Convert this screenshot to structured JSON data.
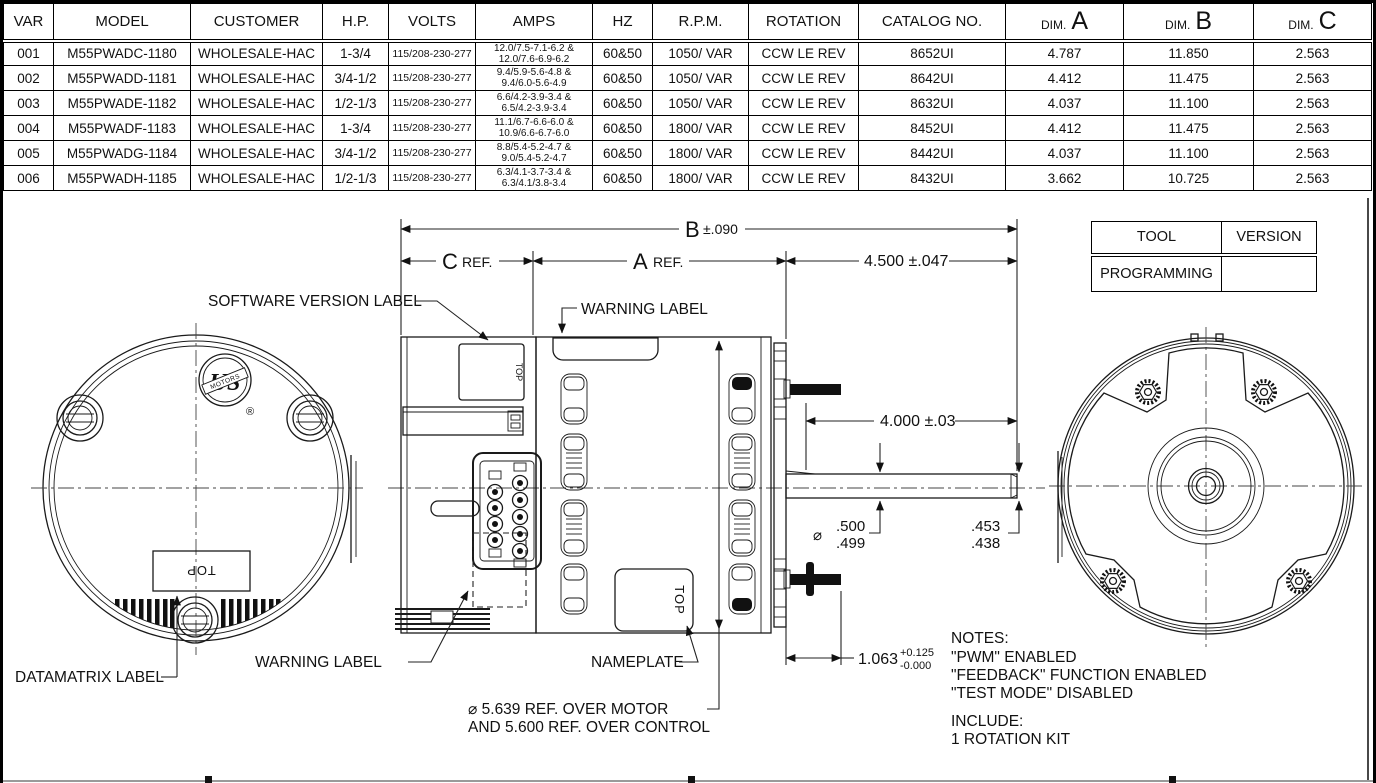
{
  "spec_table": {
    "columns": [
      {
        "label": "VAR"
      },
      {
        "label": "MODEL"
      },
      {
        "label": "CUSTOMER"
      },
      {
        "label": "H.P."
      },
      {
        "label": "VOLTS"
      },
      {
        "label": "AMPS"
      },
      {
        "label": "HZ"
      },
      {
        "label": "R.P.M."
      },
      {
        "label": "ROTATION"
      },
      {
        "label": "CATALOG NO."
      },
      {
        "label": "DIM.",
        "big": "A"
      },
      {
        "label": "DIM.",
        "big": "B"
      },
      {
        "label": "DIM.",
        "big": "C"
      }
    ],
    "rows": [
      [
        "001",
        "M55PWADC-1180",
        "WHOLESALE-HAC",
        "1-3/4",
        "115/208-230-277",
        "12.0/7.5-7.1-6.2 &\n12.0/7.6-6.9-6.2",
        "60&50",
        "1050/ VAR",
        "CCW LE REV",
        "8652UI",
        "4.787",
        "11.850",
        "2.563"
      ],
      [
        "002",
        "M55PWADD-1181",
        "WHOLESALE-HAC",
        "3/4-1/2",
        "115/208-230-277",
        "9.4/5.9-5.6-4.8 &\n9.4/6.0-5.6-4.9",
        "60&50",
        "1050/ VAR",
        "CCW LE REV",
        "8642UI",
        "4.412",
        "11.475",
        "2.563"
      ],
      [
        "003",
        "M55PWADE-1182",
        "WHOLESALE-HAC",
        "1/2-1/3",
        "115/208-230-277",
        "6.6/4.2-3.9-3.4 &\n6.5/4.2-3.9-3.4",
        "60&50",
        "1050/ VAR",
        "CCW LE REV",
        "8632UI",
        "4.037",
        "11.100",
        "2.563"
      ],
      [
        "004",
        "M55PWADF-1183",
        "WHOLESALE-HAC",
        "1-3/4",
        "115/208-230-277",
        "11.1/6.7-6.6-6.0 &\n10.9/6.6-6.7-6.0",
        "60&50",
        "1800/ VAR",
        "CCW LE REV",
        "8452UI",
        "4.412",
        "11.475",
        "2.563"
      ],
      [
        "005",
        "M55PWADG-1184",
        "WHOLESALE-HAC",
        "3/4-1/2",
        "115/208-230-277",
        "8.8/5.4-5.2-4.7 &\n9.0/5.4-5.2-4.7",
        "60&50",
        "1800/ VAR",
        "CCW LE REV",
        "8442UI",
        "4.037",
        "11.100",
        "2.563"
      ],
      [
        "006",
        "M55PWADH-1185",
        "WHOLESALE-HAC",
        "1/2-1/3",
        "115/208-230-277",
        "6.3/4.1-3.7-3.4 &\n6.3/4.1/3.8-3.4",
        "60&50",
        "1800/ VAR",
        "CCW LE REV",
        "8432UI",
        "3.662",
        "10.725",
        "2.563"
      ]
    ]
  },
  "tool_table": {
    "col1": "TOOL",
    "col2": "VERSION",
    "row1": {
      "tool": "PROGRAMMING",
      "version": ""
    }
  },
  "drawing": {
    "labels": {
      "software_version_label": "SOFTWARE VERSION LABEL",
      "warning_label_top": "WARNING LABEL",
      "warning_label_bottom": "WARNING LABEL",
      "datamatrix_label": "DATAMATRIX LABEL",
      "nameplate_label": "NAMEPLATE",
      "top_marking_back": "TOP",
      "top_marking_control": "TOP",
      "top_marking_nameplate": "TOP"
    },
    "dims": {
      "b_letter": "B",
      "b_tol": "±.090",
      "c_letter": "C",
      "c_suffix": "REF.",
      "a_letter": "A",
      "a_suffix": "REF.",
      "shaft_ext": "4.500 ±.047",
      "shaft_len": "4.000 ±.03",
      "dia_sym": "⌀",
      "shaft_dia_hi": ".500",
      "shaft_dia_lo": ".499",
      "flat_hi": ".453",
      "flat_lo": ".438",
      "stud_len": "1.063",
      "stud_plus": "+0.125",
      "stud_minus": "-0.000",
      "dia_ref_1": "⌀ 5.639  REF. OVER MOTOR",
      "dia_ref_2": "AND 5.600 REF. OVER CONTROL"
    },
    "notes": {
      "title": "NOTES:",
      "lines": [
        "\"PWM\" ENABLED",
        "\"FEEDBACK\" FUNCTION ENABLED",
        "\"TEST MODE\" DISABLED"
      ],
      "include_title": "INCLUDE:",
      "include_lines": [
        "1 ROTATION KIT"
      ]
    },
    "logo": {
      "us": "US",
      "motors": "MOTORS",
      "reg": "®"
    }
  }
}
